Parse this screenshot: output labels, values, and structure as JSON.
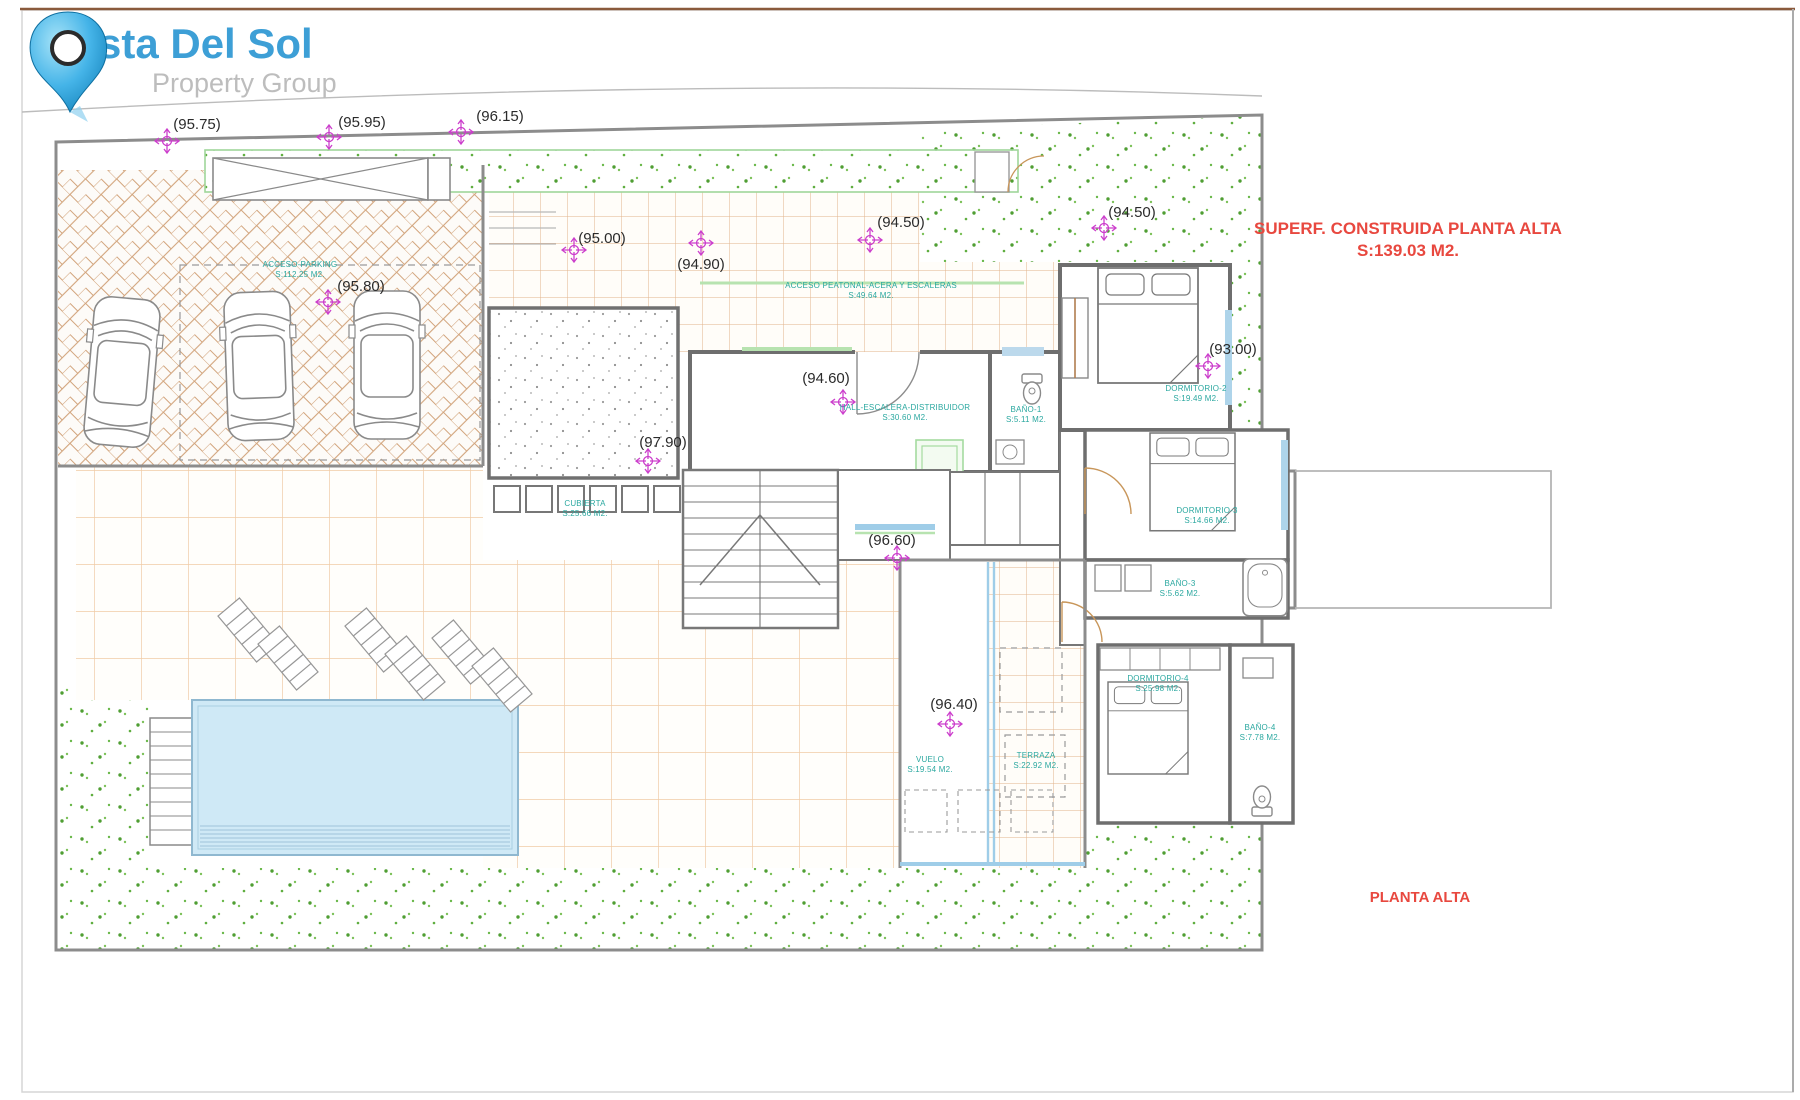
{
  "logo": {
    "title": "Costa Del Sol",
    "subtitle": "Property Group"
  },
  "titles": {
    "superf_line1": "SUPERF. CONSTRUIDA PLANTA ALTA",
    "superf_line2": "S:139.03 M2.",
    "plan_title": "PLANTA ALTA"
  },
  "colors": {
    "accent_red": "#e8483f",
    "label_teal": "#2ba8a0",
    "marker_magenta": "#cc3fcc",
    "logo_blue": "#3d9fd6",
    "tile_orange": "#e2b48c",
    "grass_green": "#4f9e33",
    "pool_blue": "#cfe9f6"
  },
  "markers": [
    {
      "label": "(95.75)"
    },
    {
      "label": "(95.95)"
    },
    {
      "label": "(96.15)"
    },
    {
      "label": "(95.00)"
    },
    {
      "label": "(94.90)"
    },
    {
      "label": "(94.50)"
    },
    {
      "label": "(94.50)"
    },
    {
      "label": "(95.80)"
    },
    {
      "label": "(94.60)"
    },
    {
      "label": "(97.90)"
    },
    {
      "label": "(96.60)"
    },
    {
      "label": "(93.00)"
    },
    {
      "label": "(96.40)"
    }
  ],
  "rooms": {
    "parking": {
      "name": "ACCESO-PARKING",
      "area": "S:112.25 M2."
    },
    "peatonal": {
      "name": "ACCESO PEATONAL-ACERA Y ESCALERAS",
      "area": "S:49.64 M2."
    },
    "cubierta": {
      "name": "CUBIERTA",
      "area": "S:25.66 M2."
    },
    "hall": {
      "name": "HALL-ESCALERA-DISTRIBUIDOR",
      "area": "S:30.60 M2."
    },
    "banyo1": {
      "name": "BAÑO-1",
      "area": "S:5.11 M2."
    },
    "dorm2": {
      "name": "DORMITORIO-2",
      "area": "S:19.49 M2."
    },
    "dorm3": {
      "name": "DORMITORIO-3",
      "area": "S:14.66 M2."
    },
    "banyo3": {
      "name": "BAÑO-3",
      "area": "S:5.62 M2."
    },
    "dorm4": {
      "name": "DORMITORIO-4",
      "area": "S:25.98 M2."
    },
    "banyo4": {
      "name": "BAÑO-4",
      "area": "S:7.78 M2."
    },
    "terraza": {
      "name": "TERRAZA",
      "area": "S:22.92 M2."
    },
    "vuelo": {
      "name": "VUELO",
      "area": "S:19.54 M2."
    }
  }
}
